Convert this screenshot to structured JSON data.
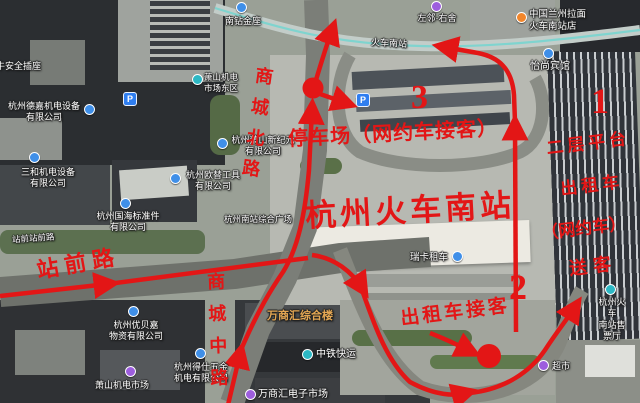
{
  "red": {
    "color": "#e31616",
    "station_name": "杭州火车南站",
    "parking_pickup": "停车场（网约车接客）",
    "platform": {
      "l1": "二层平台",
      "l2": "出租车",
      "l3": "（网约车）",
      "l4": "送客"
    },
    "taxi_pickup": "出租车接客",
    "roads": {
      "shangcheng_north": "商城北路",
      "shangcheng_middle": "商城中路",
      "zhanqian": "站前路"
    },
    "markers": {
      "n1": "1",
      "n2": "2",
      "n3": "3"
    }
  },
  "pois": {
    "anquan": "牛安全插座",
    "nanzuan": "南钻金座",
    "dejia": "杭州德嘉机电设备\n有限公司",
    "sanhe": "三和机电设备\n有限公司",
    "guohai": "杭州国海标准件\n有限公司",
    "zhanqian_st": "站前站前路",
    "youbeijia": "杭州优贝嘉\n物资有限公司",
    "jidian_market": "萧山机电市场",
    "deshi": "杭州得仕五金\n机电有限公司",
    "jidian_east": "萧山机电\n市场东区",
    "xinjiyuan": "杭州萧山新纪元\n有限公司",
    "outi": "杭州欧替工具\n有限公司",
    "nanzhan_plaza": "杭州南站综合广场",
    "wanshanghui": "万商汇综合楼",
    "zhongtie": "中铁快运",
    "wanshanghui_elec": "万商汇电子市场",
    "zuolin": "左邻·右舍",
    "lanzhou": "中国兰州拉面\n火车南站店",
    "yishang": "怡尚宾馆",
    "huoche_nanzhan_road": "火车南站",
    "ruika": "瑞卡租车",
    "shoupiaoting": "杭州火车\n南站售票厅",
    "chaoshi": "超市",
    "parking_glyph": "P"
  }
}
